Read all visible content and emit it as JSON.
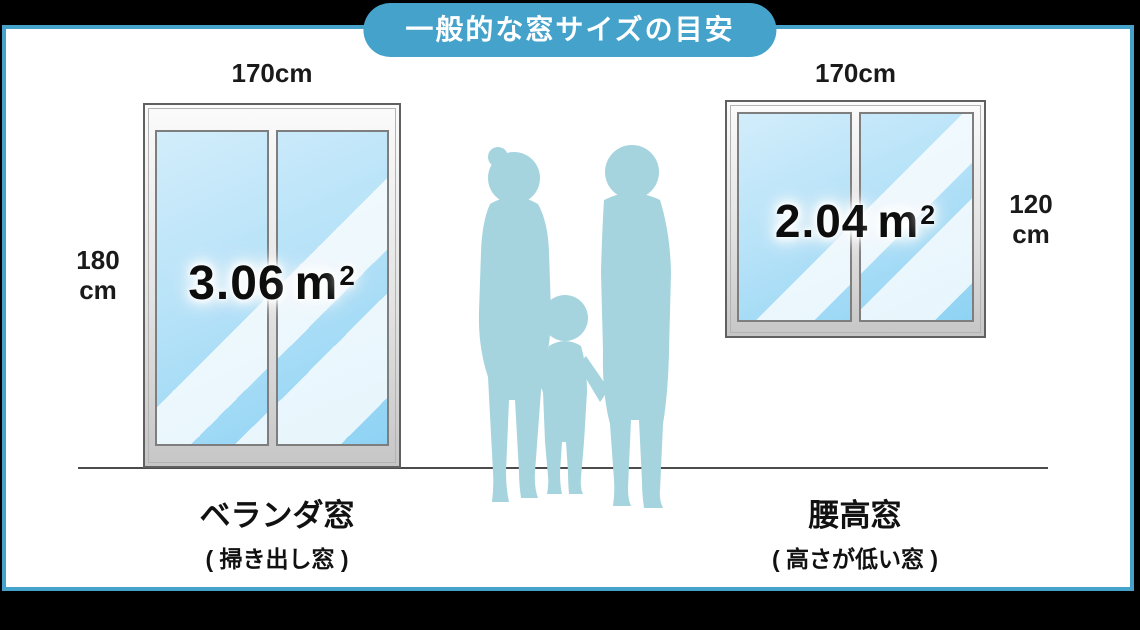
{
  "title": "一般的な窓サイズの目安",
  "colors": {
    "accent_blue": "#45A2CB",
    "glass_blue": "#A9DDF6",
    "silhouette_blue": "#A5D4DE",
    "background": "#000000",
    "panel": "#FFFFFF"
  },
  "windows": {
    "left": {
      "width_label": "170cm",
      "height_value": "180",
      "height_unit": "cm",
      "area_value": "3.06",
      "unit_base": "m",
      "unit_exp": "2",
      "name": "ベランダ窓",
      "subname": "( 掃き出し窓 )"
    },
    "right": {
      "width_label": "170cm",
      "height_value": "120",
      "height_unit": "cm",
      "area_value": "2.04",
      "unit_base": "m",
      "unit_exp": "2",
      "name": "腰高窓",
      "subname": "( 高さが低い窓 )"
    }
  }
}
